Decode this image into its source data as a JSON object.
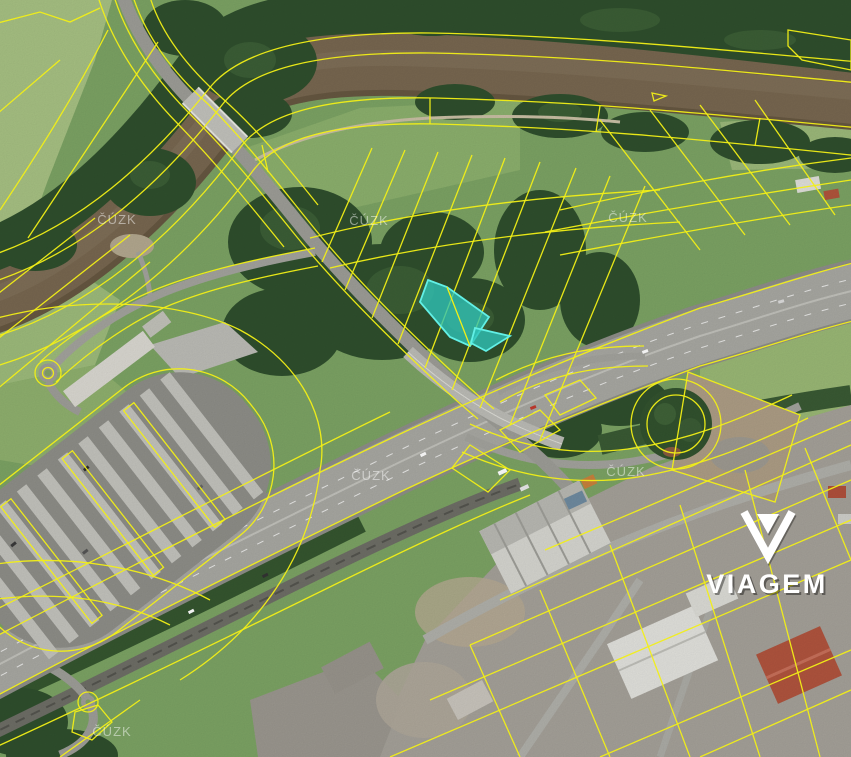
{
  "map": {
    "kind": "satellite-cadastral-view",
    "provider_watermark": "ČÚZK",
    "brand": {
      "name": "VIAGEM"
    },
    "highlighted_parcel": {
      "fill": "#2fc4b8",
      "stroke": "#62f0e6"
    },
    "cadastral_line_color": "#f2ef16"
  }
}
